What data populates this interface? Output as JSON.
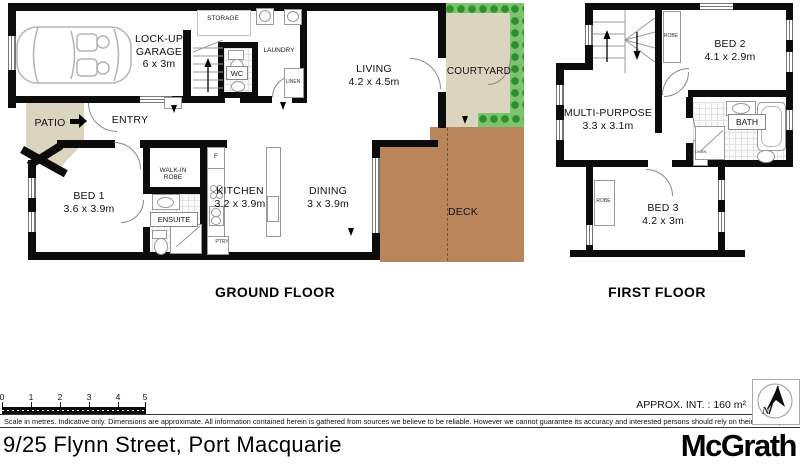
{
  "ground": {
    "title": "GROUND FLOOR",
    "rooms": {
      "garage": {
        "name": "LOCK-UP GARAGE",
        "dims": "6 x 3m"
      },
      "storage": {
        "name": "STORAGE"
      },
      "wc": {
        "name": "WC"
      },
      "laundry": {
        "name": "LAUNDRY"
      },
      "linen": {
        "name": "LINEN"
      },
      "living": {
        "name": "LIVING",
        "dims": "4.2 x 4.5m"
      },
      "courtyard": {
        "name": "COURTYARD"
      },
      "patio": {
        "name": "PATIO"
      },
      "entry": {
        "name": "ENTRY"
      },
      "bed1": {
        "name": "BED 1",
        "dims": "3.6 x 3.9m"
      },
      "wir": {
        "name": "WALK-IN ROBE"
      },
      "ensuite": {
        "name": "ENSUITE"
      },
      "kitchen": {
        "name": "KITCHEN",
        "dims": "3.2 x 3.9m"
      },
      "fridge": {
        "name": "F"
      },
      "pantry": {
        "name": "PTRY"
      },
      "dining": {
        "name": "DINING",
        "dims": "3 x 3.9m"
      },
      "deck": {
        "name": "DECK"
      }
    }
  },
  "first": {
    "title": "FIRST FLOOR",
    "rooms": {
      "bed2": {
        "name": "BED 2",
        "dims": "4.1 x 2.9m"
      },
      "robe2": {
        "name": "ROBE"
      },
      "multi": {
        "name": "MULTI-PURPOSE",
        "dims": "3.3 x 3.1m"
      },
      "bath": {
        "name": "BATH"
      },
      "linen": {
        "name": "LINEN"
      },
      "robe3": {
        "name": "ROBE"
      },
      "bed3": {
        "name": "BED 3",
        "dims": "4.2 x 3m"
      }
    }
  },
  "footer": {
    "scale_ticks": [
      "0",
      "1",
      "2",
      "3",
      "4",
      "5"
    ],
    "disclaimer": "Scale in metres. Indicative only. Dimensions are approximate. All information contained herein is gathered from sources we believe to be reliable. However we cannot guarantee its accuracy and interested persons should rely on their own inquiries",
    "approx_int": "APPROX. INT. :  160 m²",
    "address": "9/25 Flynn Street, Port Macquarie",
    "brand": "McGrath",
    "compass_label": "N"
  },
  "colors": {
    "wall": "#0c0c0c",
    "deck": "#b9855a",
    "courtyard_paving": "#dbd5c0",
    "plants_green": "#7cc36e",
    "bush_green": "#2f8f2f"
  }
}
